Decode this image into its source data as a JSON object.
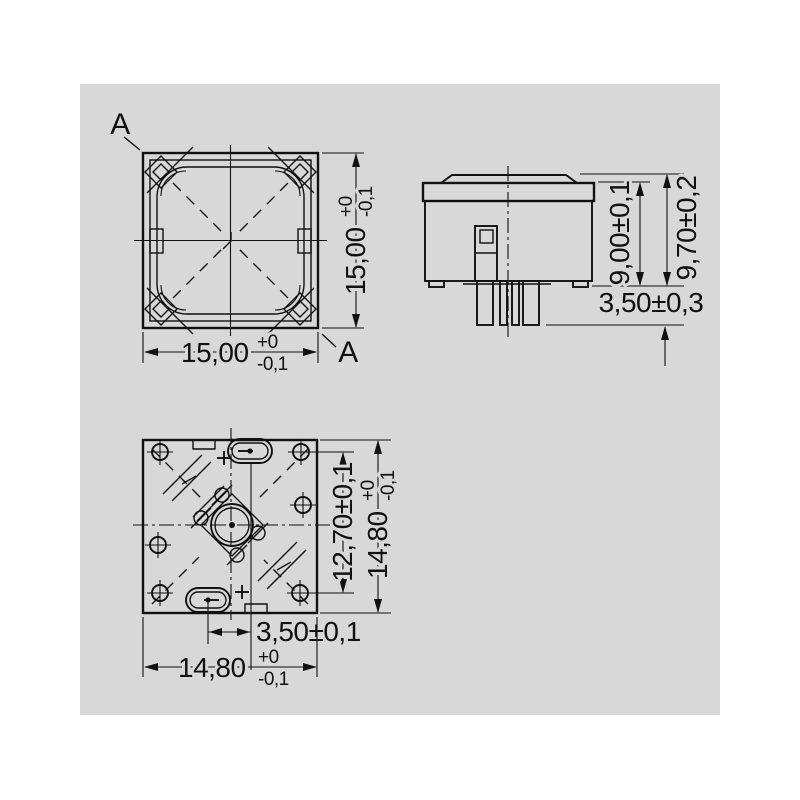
{
  "drawing": {
    "colors": {
      "page": "#ffffff",
      "panel_background": "#d8d8d8",
      "line": "#111111"
    },
    "section_label": "A",
    "front_view": {
      "width": {
        "value": "15,00",
        "tol_plus": "+0",
        "tol_minus": "-0,1"
      },
      "height": {
        "value": "15,00",
        "tol_plus": "+0",
        "tol_minus": "-0,1"
      }
    },
    "side_view": {
      "body_height": "9,00±0,1",
      "overall_height": "9,70±0,2",
      "pin_length": "3,50±0,3"
    },
    "bottom_view": {
      "hole_span": "12,70±0,1",
      "slot_offset": "3,50±0,1",
      "width": {
        "value": "14,80",
        "tol_plus": "+0",
        "tol_minus": "-0,1"
      },
      "height": {
        "value": "14,80",
        "tol_plus": "+0",
        "tol_minus": "-0,1"
      }
    }
  }
}
